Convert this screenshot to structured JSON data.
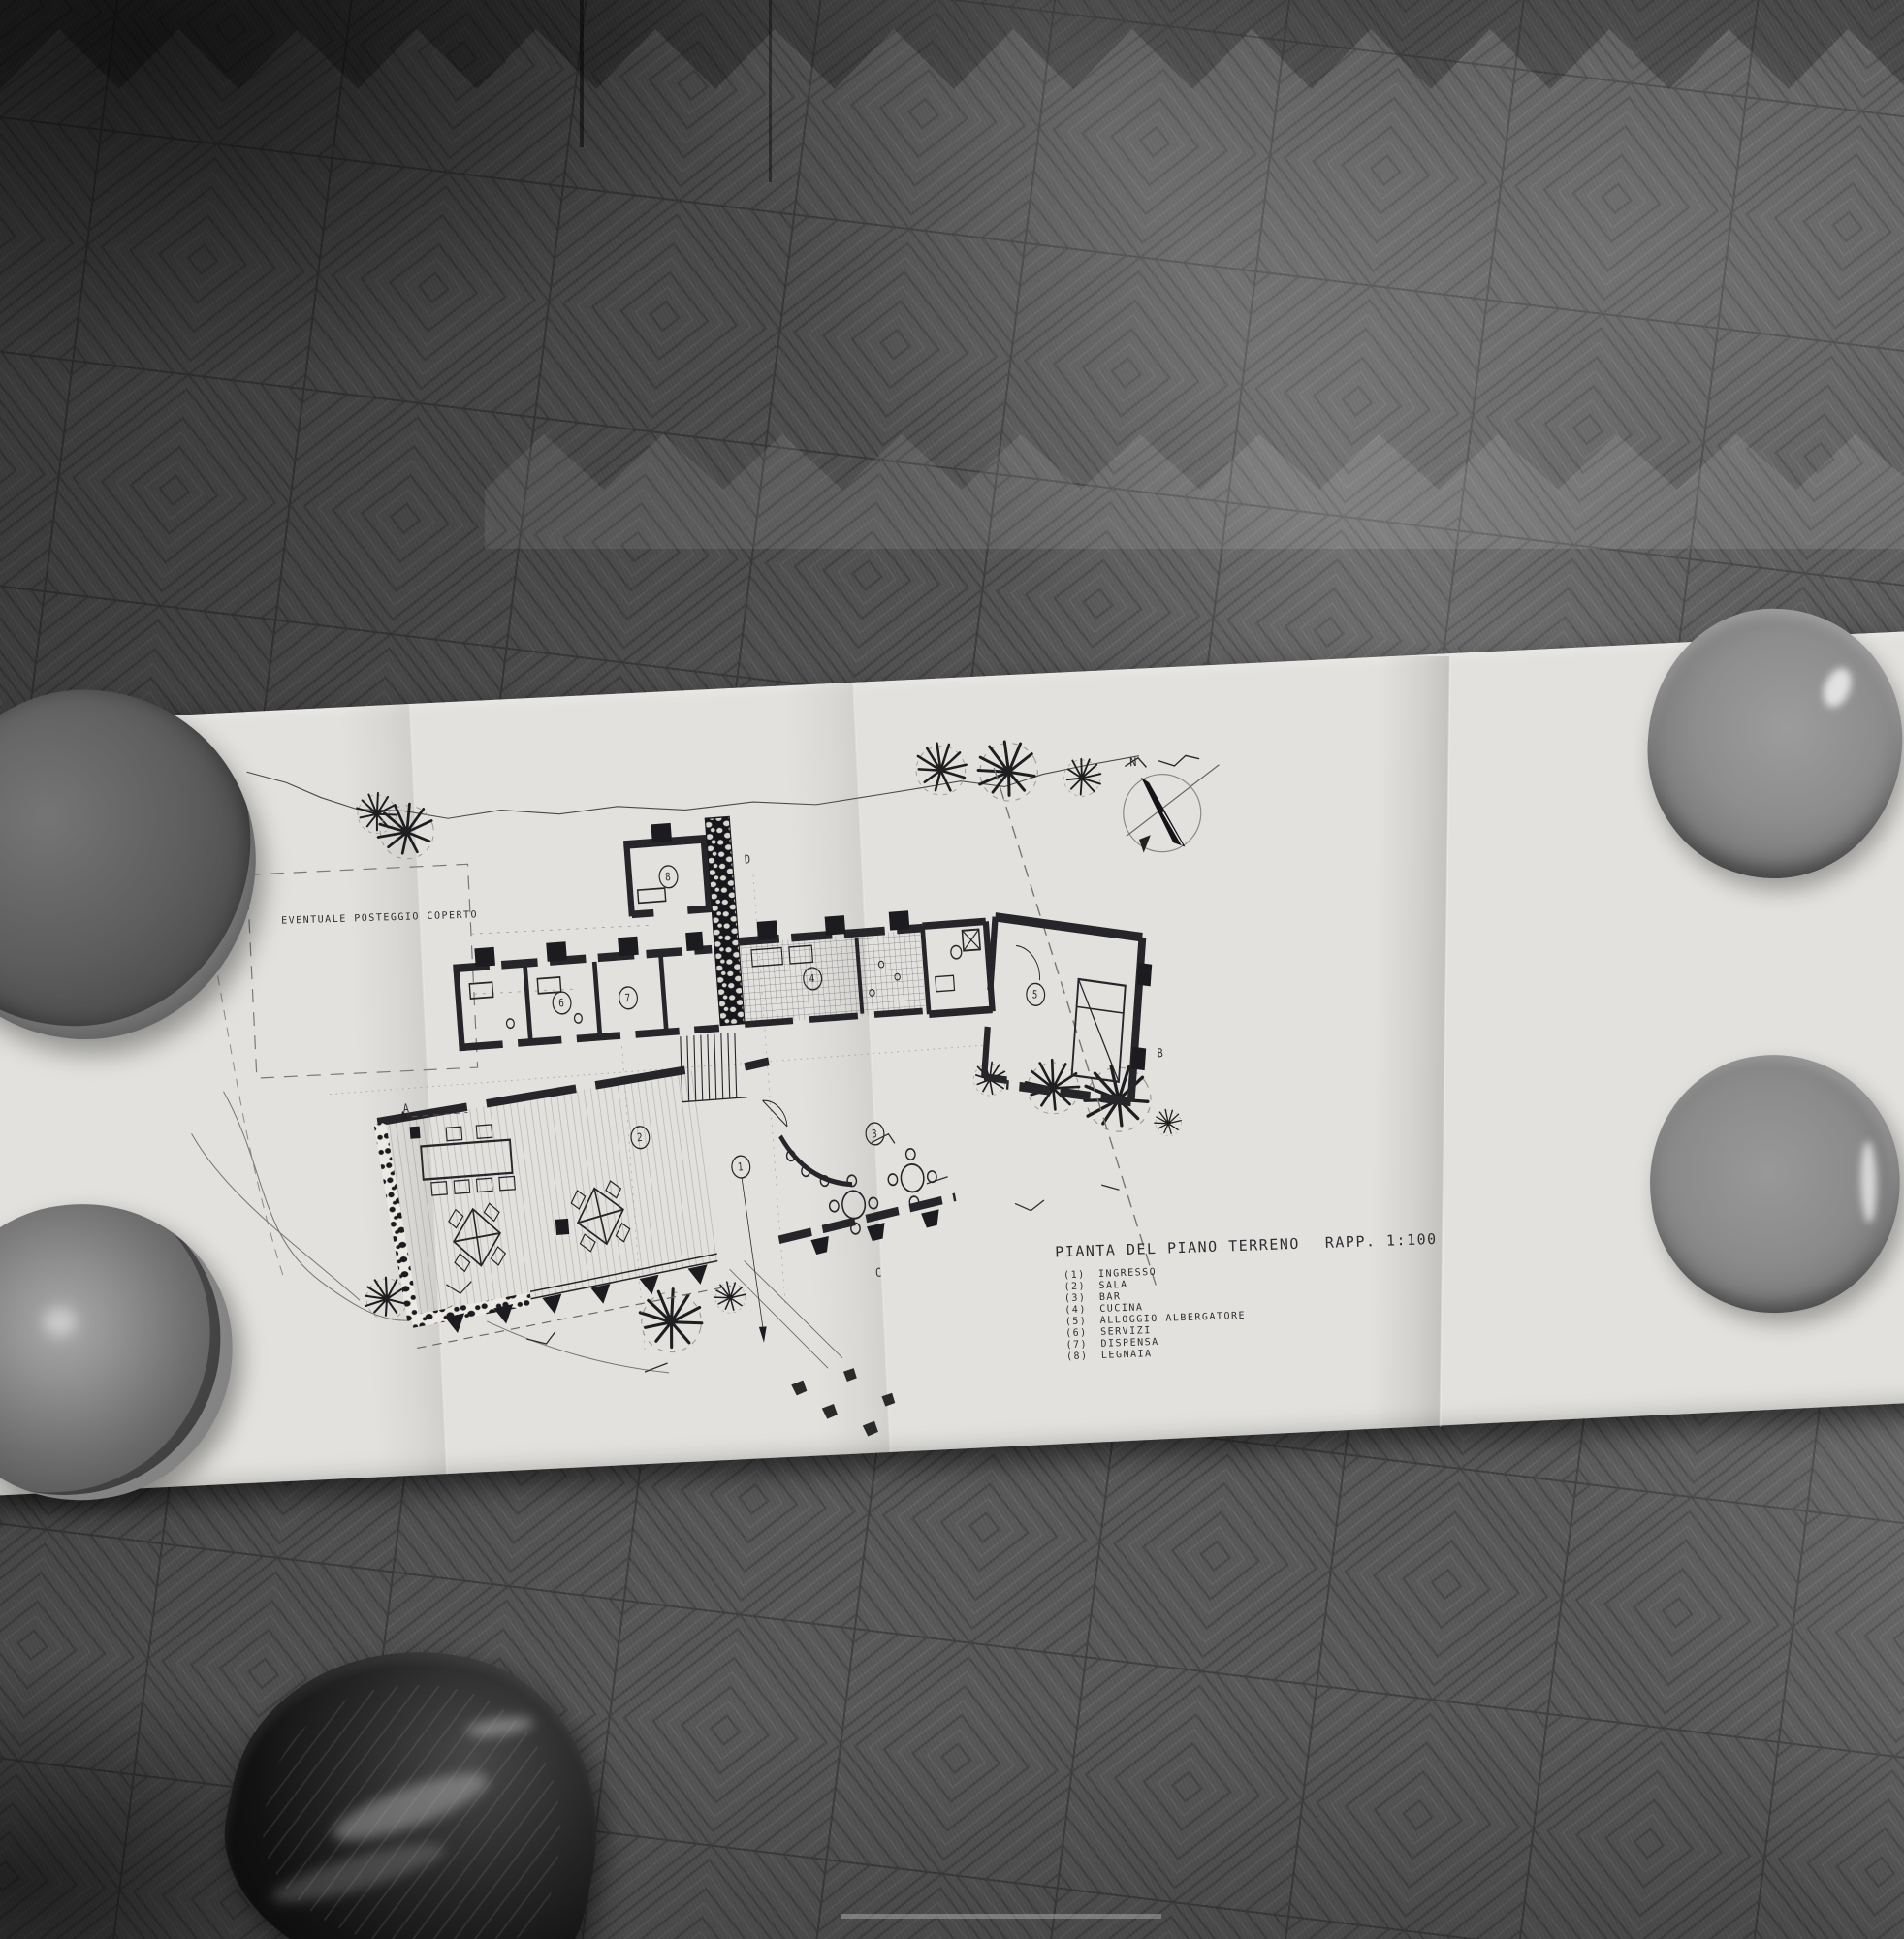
{
  "plan": {
    "title": "PIANTA DEL PIANO TERRENO",
    "scale": "RAPP. 1:100",
    "site_note": "EVENTUALE POSTEGGIO COPERTO",
    "compass_north_label": "N",
    "rooms": [
      {
        "tag": "(1)",
        "num": "1",
        "name": "INGRESSO"
      },
      {
        "tag": "(2)",
        "num": "2",
        "name": "SALA"
      },
      {
        "tag": "(3)",
        "num": "3",
        "name": "BAR"
      },
      {
        "tag": "(4)",
        "num": "4",
        "name": "CUCINA"
      },
      {
        "tag": "(5)",
        "num": "5",
        "name": "ALLOGGIO ALBERGATORE"
      },
      {
        "tag": "(6)",
        "num": "6",
        "name": "SERVIZI"
      },
      {
        "tag": "(7)",
        "num": "7",
        "name": "DISPENSA"
      },
      {
        "tag": "(8)",
        "num": "8",
        "name": "LEGNAIA"
      }
    ],
    "section_markers": {
      "a": "A",
      "b": "B",
      "c": "C",
      "d": "D"
    }
  },
  "colors": {
    "floor_base": "#575757",
    "paper": "#e2e1dd",
    "ink": "#26262a",
    "bowl_dark": "#555555",
    "bowl_light": "#8f8f8f",
    "shoe": "#121212"
  }
}
